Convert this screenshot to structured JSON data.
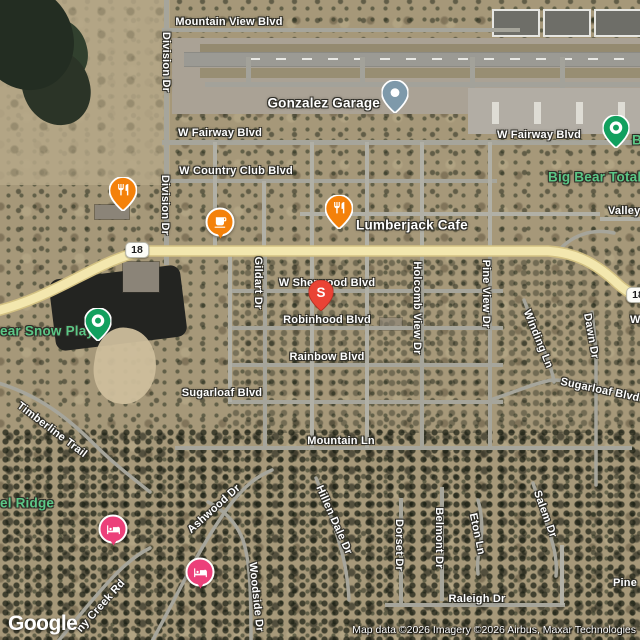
{
  "map": {
    "provider": "Google",
    "attribution": "Map data ©2026 Imagery ©2026 Airbus, Maxar Technologies",
    "highway_shield": {
      "route": "18"
    },
    "colors": {
      "restaurant_orange": "#f4810a",
      "poi_green": "#12a05e",
      "hotel_pink": "#ec407a",
      "business_gray": "#7e99aa",
      "search_red": "#ea4335",
      "highway_yellow": "#f3e7ae",
      "road_gray": "#a6a59b",
      "green_label": "#5cc786"
    },
    "streets": {
      "mountain_view": "Mountain View Blvd",
      "division_top": "Division Dr",
      "division_mid": "Division Dr",
      "fairway_left": "W Fairway Blvd",
      "fairway_right": "W Fairway Blvd",
      "country_club": "W Country Club Blvd",
      "valley": "Valley",
      "gildart": "Gildart Dr",
      "sherwood": "W Sherwood Blvd",
      "robinhood": "Robinhood Blvd",
      "rainbow": "Rainbow Blvd",
      "sugarloaf_left": "Sugarloaf Blvd",
      "sugarloaf_right": "Sugarloaf Blvd",
      "holcomb": "Holcomb View Dr",
      "pine_view": "Pine View Dr",
      "winding": "Winding Ln",
      "dawn": "Dawn Dr",
      "w_partial": "W",
      "timberline": "Timberline Trail",
      "mountain_ln": "Mountain Ln",
      "ashwood": "Ashwood Dr",
      "creek_rd": "ny Creek Rd",
      "woodside": "Woodside Dr",
      "hillendale": "Hillen Dale Dr",
      "dorset": "Dorset Dr",
      "belmont": "Belmont Dr",
      "eton": "Eton Ln",
      "salem": "Salem Dr",
      "raleigh": "Raleigh Dr",
      "pine_partial": "Pine"
    },
    "pois": {
      "gonzalez": {
        "label": "Gonzalez Garage"
      },
      "lumberjack": {
        "label": "Lumberjack Cafe"
      },
      "big_bear_total": {
        "label": "Big Bear Total"
      },
      "big_bear_partial": {
        "label": "B"
      },
      "snow_play": {
        "label": "ear Snow Play"
      },
      "el_ridge": {
        "label": "el Ridge"
      },
      "search_marker": {
        "label": "S"
      }
    }
  }
}
